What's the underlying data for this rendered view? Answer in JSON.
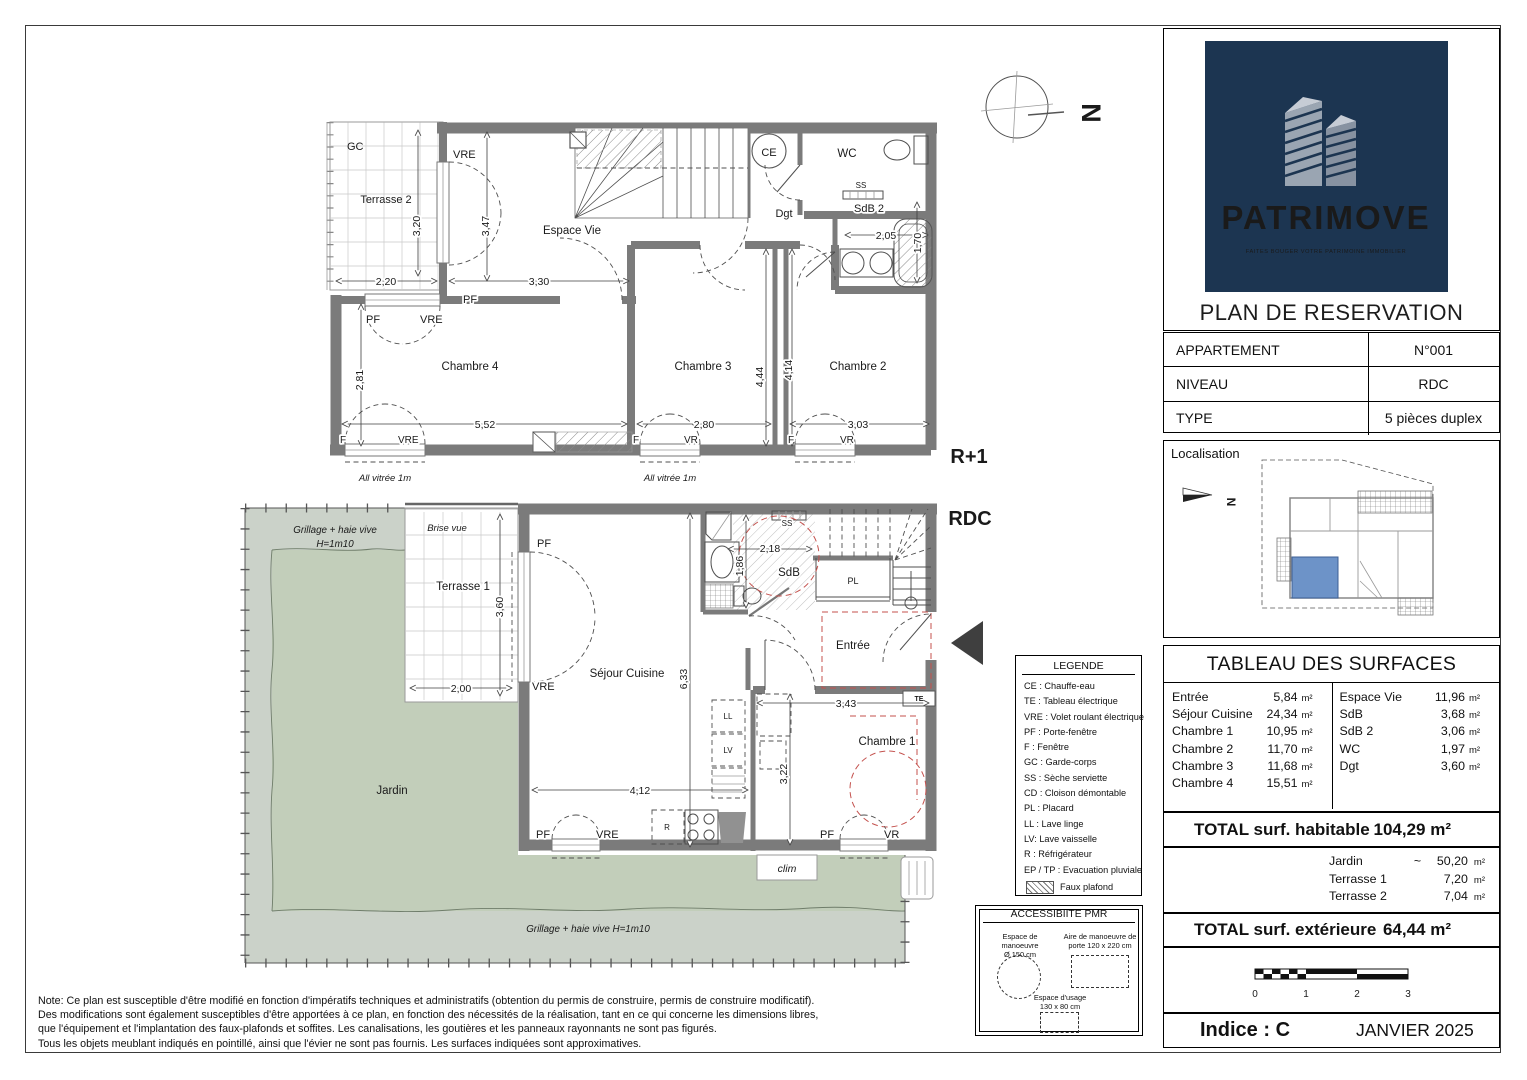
{
  "sidebar": {
    "logo": {
      "brand": "PATRIMOVE",
      "tagline": "FAITES BOUGER VOTRE PATRIMOINE IMMOBILIER"
    },
    "plan_title": "PLAN DE RESERVATION",
    "info_rows": [
      {
        "label": "APPARTEMENT",
        "value": "N°001"
      },
      {
        "label": "NIVEAU",
        "value": "RDC"
      },
      {
        "label": "TYPE",
        "value": "5 pièces duplex"
      }
    ],
    "localisation": {
      "title": "Localisation",
      "labels": [
        {
          "t": "N",
          "x": 1227,
          "y": 501,
          "r": 90,
          "s": 12,
          "b": 1
        }
      ]
    },
    "surfaces": {
      "title": "TABLEAU DES SURFACES",
      "left": [
        {
          "n": "Entrée",
          "v": "5,84",
          "u": "m²"
        },
        {
          "n": "Séjour Cuisine",
          "v": "24,34",
          "u": "m²"
        },
        {
          "n": "Chambre 1",
          "v": "10,95",
          "u": "m²"
        },
        {
          "n": "Chambre 2",
          "v": "11,70",
          "u": "m²"
        },
        {
          "n": "Chambre 3",
          "v": "11,68",
          "u": "m²"
        },
        {
          "n": "Chambre 4",
          "v": "15,51",
          "u": "m²"
        }
      ],
      "right": [
        {
          "n": "Espace Vie",
          "v": "11,96",
          "u": "m²"
        },
        {
          "n": "SdB",
          "v": "3,68",
          "u": "m²"
        },
        {
          "n": "SdB 2",
          "v": "3,06",
          "u": "m²"
        },
        {
          "n": "WC",
          "v": "1,97",
          "u": "m²"
        },
        {
          "n": "Dgt",
          "v": "3,60",
          "u": "m²"
        }
      ],
      "total_hab_label": "TOTAL surf. habitable",
      "total_hab_value": "104,29 m²",
      "exterior": [
        {
          "n": "Jardin",
          "a": "~",
          "v": "50,20",
          "u": "m²"
        },
        {
          "n": "Terrasse 1",
          "a": "",
          "v": "7,20",
          "u": "m²"
        },
        {
          "n": "Terrasse 2",
          "a": "",
          "v": "7,04",
          "u": "m²"
        }
      ],
      "total_ext_label": "TOTAL surf. extérieure",
      "total_ext_value": "64,44 m²"
    },
    "scale": {
      "labels": [
        {
          "t": "0",
          "x": 1255,
          "y": 996,
          "s": 10
        },
        {
          "t": "1",
          "x": 1306,
          "y": 996,
          "s": 10
        },
        {
          "t": "2",
          "x": 1357,
          "y": 996,
          "s": 10
        },
        {
          "t": "3",
          "x": 1408,
          "y": 996,
          "s": 10
        }
      ]
    },
    "indice": "Indice : C",
    "date": "JANVIER 2025"
  },
  "legend": {
    "title": "LEGENDE",
    "items": [
      "CE : Chauffe-eau",
      "TE : Tableau électrique",
      "VRE : Volet roulant électrique",
      "PF : Porte-fenêtre",
      "F : Fenêtre",
      "GC : Garde-corps",
      "SS : Sèche serviette",
      "CD : Cloison démontable",
      "PL : Placard",
      "LL : Lave linge",
      "LV: Lave vaisselle",
      "R : Réfrigérateur",
      "EP / TP : Evacuation pluviale"
    ],
    "faux": "Faux plafond"
  },
  "pmr": {
    "title": "ACCESSIBIITE PMR",
    "items": [
      {
        "t1": "Espace de manoeuvre",
        "t2": "Ø 150 cm"
      },
      {
        "t1": "Aire de manoeuvre de",
        "t2": "porte 120 x 220 cm"
      },
      {
        "t1": "Espace d'usage",
        "t2": "130 x 80 cm"
      }
    ]
  },
  "notes": [
    "Note: Ce plan est susceptible d'être modifié en fonction d'impératifs techniques et administratifs (obtention du permis de construire, permis de construire modificatif).",
    "Des modifications sont également susceptibles d'être apportées à ce plan, en fonction des nécessités de la réalisation, tant en ce qui concerne les dimensions libres,",
    "que l'équipement et l'implantation des faux-plafonds et soffites. Les canalisations, les goutières et les panneaux rayonnants ne sont pas figurés.",
    "Tous les objets meublant indiqués en pointillé, ainsi que l'évier ne sont pas fournis. Les surfaces indiquées sont approximatives."
  ],
  "plans": {
    "compass": {
      "labels": [
        {
          "t": "N",
          "x": 1082,
          "y": 113,
          "r": 90,
          "s": 27,
          "b": 1
        }
      ]
    },
    "r1": {
      "labels": [
        {
          "t": "GC",
          "x": 347,
          "y": 150,
          "a": "s",
          "s": 11
        },
        {
          "t": "Terrasse 2",
          "x": 386,
          "y": 203,
          "s": 11
        },
        {
          "t": "3,20",
          "x": 420,
          "y": 226,
          "r": -90,
          "s": 10.5,
          "h": 1
        },
        {
          "t": "2,20",
          "x": 386,
          "y": 285,
          "s": 10.5,
          "h": 1
        },
        {
          "t": "VRE",
          "x": 453,
          "y": 158,
          "a": "s",
          "s": 11,
          "h": 1
        },
        {
          "t": "3,47",
          "x": 489,
          "y": 226,
          "r": -90,
          "s": 10.5,
          "h": 1
        },
        {
          "t": "Espace Vie",
          "x": 572,
          "y": 234,
          "s": 11.5
        },
        {
          "t": "3,30",
          "x": 539,
          "y": 285,
          "s": 10.5,
          "h": 1
        },
        {
          "t": "PF",
          "x": 463,
          "y": 303,
          "a": "s",
          "s": 11,
          "h": 1
        },
        {
          "t": "PF",
          "x": 366,
          "y": 323,
          "a": "s",
          "s": 11,
          "h": 1
        },
        {
          "t": "VRE",
          "x": 420,
          "y": 323,
          "a": "s",
          "s": 11,
          "h": 1
        },
        {
          "t": "CE",
          "x": 769,
          "y": 156,
          "s": 11
        },
        {
          "t": "WC",
          "x": 847,
          "y": 157,
          "s": 11.5
        },
        {
          "t": "Dgt",
          "x": 784,
          "y": 217,
          "s": 11
        },
        {
          "t": "SS",
          "x": 861,
          "y": 188,
          "s": 8,
          "h": 1
        },
        {
          "t": "SdB 2",
          "x": 869,
          "y": 212,
          "s": 11,
          "h": 1
        },
        {
          "t": "2,05",
          "x": 886,
          "y": 239,
          "s": 10.5,
          "h": 1
        },
        {
          "t": "1,70",
          "x": 921,
          "y": 243,
          "r": -90,
          "s": 10.5,
          "h": 1
        },
        {
          "t": "Chambre 4",
          "x": 470,
          "y": 370,
          "s": 11.5
        },
        {
          "t": "Chambre 3",
          "x": 703,
          "y": 370,
          "s": 11.5
        },
        {
          "t": "Chambre 2",
          "x": 858,
          "y": 370,
          "s": 11.5
        },
        {
          "t": "2,81",
          "x": 363,
          "y": 380,
          "r": -90,
          "s": 10.5,
          "h": 1
        },
        {
          "t": "5,52",
          "x": 485,
          "y": 428,
          "s": 10.5,
          "h": 1
        },
        {
          "t": "2,80",
          "x": 704,
          "y": 428,
          "s": 10.5,
          "h": 1
        },
        {
          "t": "3,03",
          "x": 858,
          "y": 428,
          "s": 10.5,
          "h": 1
        },
        {
          "t": "4,44",
          "x": 763,
          "y": 377,
          "r": -90,
          "s": 10.5,
          "h": 1
        },
        {
          "t": "4,14",
          "x": 792,
          "y": 370,
          "r": -90,
          "s": 10.5,
          "h": 1
        },
        {
          "t": "F",
          "x": 340,
          "y": 443,
          "a": "s",
          "s": 10,
          "h": 1
        },
        {
          "t": "VRE",
          "x": 398,
          "y": 443,
          "a": "s",
          "s": 10,
          "h": 1
        },
        {
          "t": "F",
          "x": 633,
          "y": 443,
          "a": "s",
          "s": 10,
          "h": 1
        },
        {
          "t": "VR",
          "x": 684,
          "y": 443,
          "a": "s",
          "s": 10,
          "h": 1
        },
        {
          "t": "F",
          "x": 788,
          "y": 443,
          "a": "s",
          "s": 10,
          "h": 1
        },
        {
          "t": "VR",
          "x": 840,
          "y": 443,
          "a": "s",
          "s": 10,
          "h": 1
        },
        {
          "t": "All vitrée 1m",
          "x": 385,
          "y": 481,
          "s": 9.5,
          "i": 1
        },
        {
          "t": "All vitrée 1m",
          "x": 670,
          "y": 481,
          "s": 9.5,
          "i": 1
        },
        {
          "t": "R+1",
          "x": 969,
          "y": 463,
          "s": 20,
          "b": 1
        }
      ]
    },
    "rdc": {
      "labels": [
        {
          "t": "Grillage + haie vive",
          "x": 335,
          "y": 533,
          "s": 9.8,
          "i": 1
        },
        {
          "t": "H=1m10",
          "x": 335,
          "y": 547,
          "s": 9.8,
          "i": 1
        },
        {
          "t": "Brise vue",
          "x": 447,
          "y": 531,
          "s": 9.5,
          "i": 1,
          "h": 1
        },
        {
          "t": "Terrasse 1",
          "x": 463,
          "y": 590,
          "s": 11.5,
          "h": 1
        },
        {
          "t": "3,60",
          "x": 503,
          "y": 607,
          "r": -90,
          "s": 10.5,
          "h": 1
        },
        {
          "t": "2,00",
          "x": 461,
          "y": 692,
          "s": 10.5,
          "h": 1
        },
        {
          "t": "PF",
          "x": 537,
          "y": 547,
          "a": "s",
          "s": 11,
          "h": 1
        },
        {
          "t": "VRE",
          "x": 532,
          "y": 690,
          "a": "s",
          "s": 11,
          "h": 1
        },
        {
          "t": "Séjour Cuisine",
          "x": 627,
          "y": 677,
          "s": 11.5,
          "h": 1
        },
        {
          "t": "6,33",
          "x": 687,
          "y": 679,
          "r": -90,
          "s": 10.5,
          "h": 1
        },
        {
          "t": "SS",
          "x": 787,
          "y": 526,
          "s": 8,
          "h": 1
        },
        {
          "t": "2,18",
          "x": 770,
          "y": 552,
          "s": 10.5,
          "h": 1
        },
        {
          "t": "1,86",
          "x": 743,
          "y": 566,
          "r": -90,
          "s": 10.5,
          "h": 1
        },
        {
          "t": "SdB",
          "x": 789,
          "y": 576,
          "s": 11.5,
          "h": 1
        },
        {
          "t": "PL",
          "x": 853,
          "y": 584,
          "s": 9
        },
        {
          "t": "Entrée",
          "x": 853,
          "y": 649,
          "s": 11.5,
          "h": 1
        },
        {
          "t": "TE",
          "x": 919,
          "y": 701,
          "s": 7,
          "b": 1
        },
        {
          "t": "3,43",
          "x": 846,
          "y": 707,
          "s": 10.5,
          "h": 1
        },
        {
          "t": "LL",
          "x": 728,
          "y": 719,
          "s": 8
        },
        {
          "t": "LV",
          "x": 728,
          "y": 753,
          "s": 8
        },
        {
          "t": "Chambre 1",
          "x": 887,
          "y": 745,
          "s": 11.5,
          "h": 1
        },
        {
          "t": "3,22",
          "x": 787,
          "y": 774,
          "r": -90,
          "s": 10.5,
          "h": 1
        },
        {
          "t": "4,12",
          "x": 640,
          "y": 794,
          "s": 10.5,
          "h": 1
        },
        {
          "t": "R",
          "x": 667,
          "y": 830,
          "s": 8
        },
        {
          "t": "PF",
          "x": 536,
          "y": 838,
          "a": "s",
          "s": 11,
          "h": 1
        },
        {
          "t": "VRE",
          "x": 596,
          "y": 838,
          "a": "s",
          "s": 11,
          "h": 1
        },
        {
          "t": "PF",
          "x": 820,
          "y": 838,
          "a": "s",
          "s": 11,
          "h": 1
        },
        {
          "t": "VR",
          "x": 884,
          "y": 838,
          "a": "s",
          "s": 11,
          "h": 1
        },
        {
          "t": "clim",
          "x": 787,
          "y": 872,
          "s": 10.5,
          "i": 1
        },
        {
          "t": "Jardin",
          "x": 392,
          "y": 794,
          "s": 11.5
        },
        {
          "t": "Grillage + haie vive H=1m10",
          "x": 588,
          "y": 932,
          "s": 9.8,
          "i": 1
        },
        {
          "t": "RDC",
          "x": 970,
          "y": 525,
          "s": 20,
          "b": 1
        }
      ]
    }
  }
}
